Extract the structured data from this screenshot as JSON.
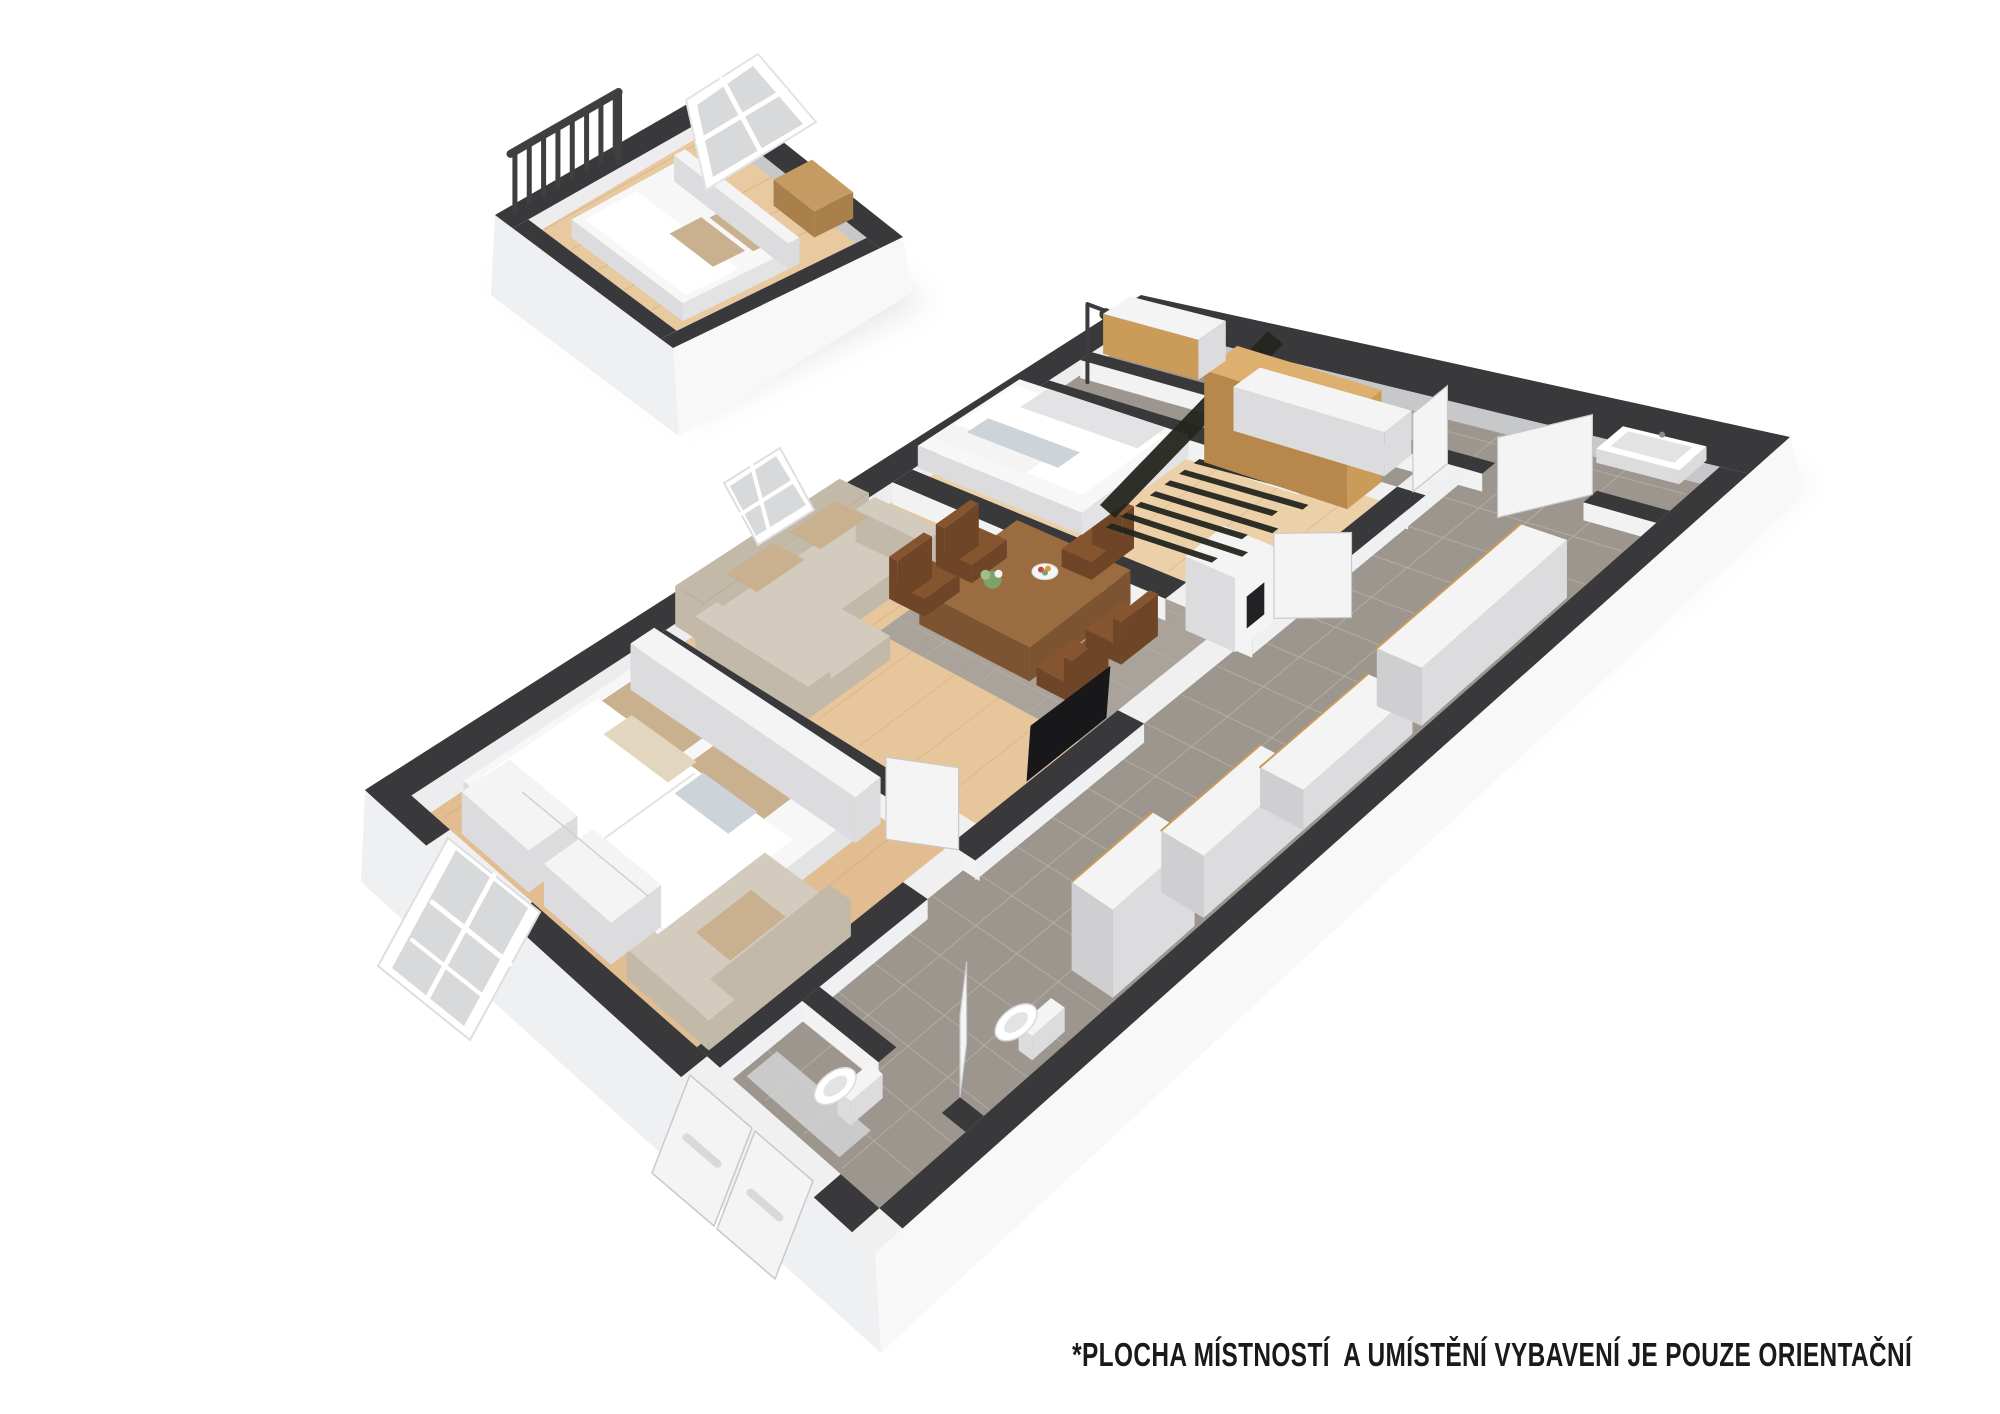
{
  "scene": {
    "label": "3d-isometric-floor-plan"
  },
  "disclaimer": {
    "text": "*PLOCHA MÍSTNOSTÍ  A UMÍSTĚNÍ VYBAVENÍ JE POUZE ORIENTAČNÍ"
  },
  "colors": {
    "bg": "#ffffff",
    "text": "#1a1a1a",
    "wall": "#39393b",
    "railing": "#3f3f41",
    "inner_face": "#ededef",
    "inner_face_gray": "#c7c8ca",
    "partition_face": "#eff0f1",
    "cross_face": "#f2f2f3",
    "underlay": "#f0f0f1",
    "base_sw": "#eef0f2",
    "base_se": "#f8f8f9",
    "shadow": "#cfcfcf",
    "wood_floor_1": "#e2bd92",
    "wood_floor_2": "#e8c69c",
    "wood_floor_3": "#ecd0a8",
    "wood_floor_attic": "#e8c9a0",
    "plank_line": "#c69a67",
    "tile": "#9c968f",
    "tile_dining": "#a9a39c",
    "tile_grout": "#c0b6a8",
    "furn_white": "#f4f4f5",
    "furn_white_side": "#dcdcde",
    "furn_white_dark": "#cfcfd2",
    "bed_white": "#f7f7f8",
    "bed_shade": "#e3e3e5",
    "pillow_beige": "#c9b190",
    "pillow_light": "#e3d6bf",
    "pillow_pattern": "#ccd3d9",
    "sofa": "#d3cbbd",
    "sofa_shade": "#c2b9a9",
    "table_top": "#9a6c40",
    "table_side": "#7d5432",
    "chair_wood": "#85552f",
    "chair_dark": "#6f4527",
    "wardrobe_top": "#ddb06f",
    "wardrobe_front": "#cb9b59",
    "wardrobe_side": "#b8874b",
    "basket": "#c59a63",
    "basket_side": "#a97f4b",
    "rug_dark": "#23251e",
    "tv_black": "#18181a",
    "firebox": "#222224",
    "glass": "#d8d9db",
    "door_stroke": "#c8c9cc",
    "fixture_inner": "#e2e3e5"
  },
  "inventory": {
    "rooms": [
      {
        "name": "attic-room",
        "floor": "wood"
      },
      {
        "name": "bedroom-1",
        "floor": "wood"
      },
      {
        "name": "living-dining-room",
        "floor": "wood-and-tile"
      },
      {
        "name": "bedroom-2",
        "floor": "wood"
      },
      {
        "name": "shower-room",
        "floor": "tile"
      },
      {
        "name": "bathroom",
        "floor": "tile"
      },
      {
        "name": "hallway",
        "floor": "tile"
      },
      {
        "name": "entry-wc",
        "floor": "tile"
      }
    ],
    "furniture": [
      "railing",
      "skylight-window",
      "attic-bed",
      "laundry-basket",
      "double-bed",
      "headboard",
      "bedroom-sofa",
      "dresser",
      "window-frame",
      "corner-sofa",
      "dining-table",
      "dining-chair",
      "flower-vase",
      "fruit-bowl",
      "tv",
      "fireplace",
      "single-bed",
      "runner-rug",
      "wardrobe",
      "shower-head",
      "nook-cabinet",
      "bathroom-cabinet",
      "sink",
      "toilet",
      "sideboard-cabinet",
      "door-leaf",
      "entry-door",
      "entry-mat"
    ]
  }
}
